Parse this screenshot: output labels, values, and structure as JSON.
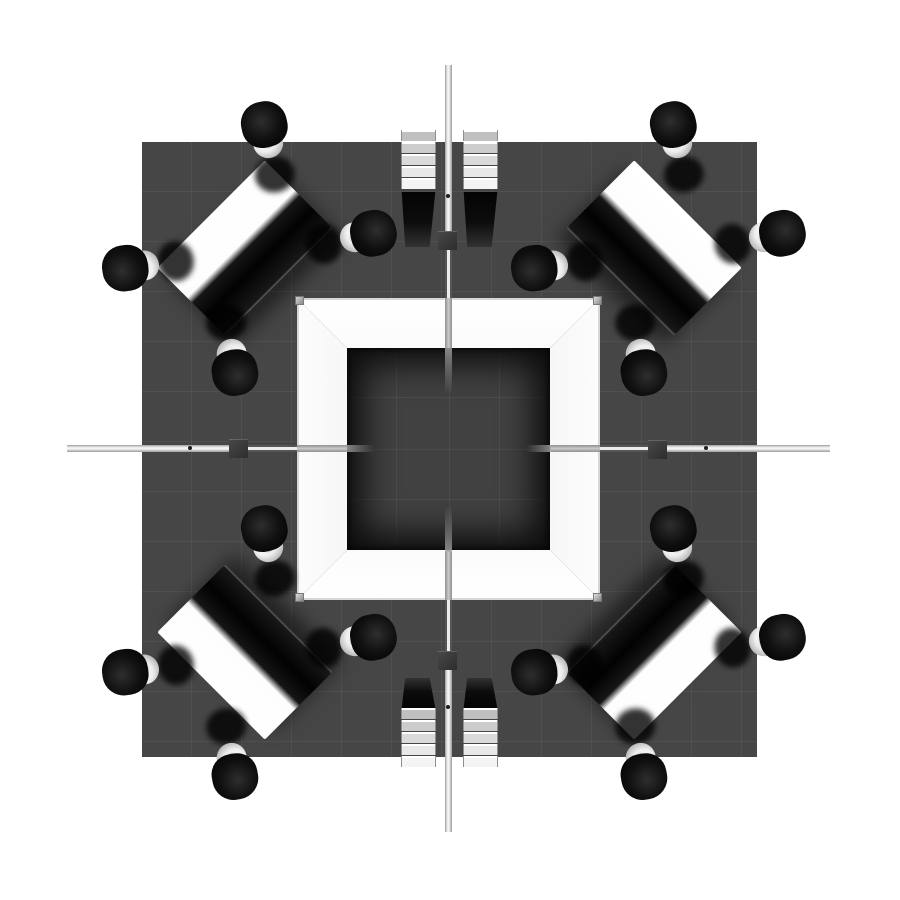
{
  "scene": {
    "title": "Overhead 3D render of a square island trade-show exhibit booth with central tower, four corner meeting tables with chairs, and four ladder display shelves",
    "canvas": {
      "width": 900,
      "height": 900,
      "background": "#ffffff"
    },
    "colors": {
      "floor": "#464646",
      "floor_grid": "rgba(255,255,255,0.055)",
      "court_floor": "#414141",
      "court_grid": "rgba(255,255,255,0.05)",
      "wall_bright": "#ffffff",
      "wall_shade": "#bfbfbf",
      "corner_post": "#b0b0b0",
      "beam_light": "#ededed",
      "beam_edge": "#9a9a9a",
      "connector_block": "#3a3a3a",
      "table_top": "#ffffff",
      "table_dark_half": "#050505",
      "chair_seat": "#0b0b0b",
      "chair_base": "#e8e8e8",
      "shelf_shadow": "#0a0a0a"
    },
    "floor": {
      "x": 142,
      "y": 142,
      "width": 615,
      "height": 615
    },
    "tower": {
      "x": 297,
      "y": 298,
      "width": 303,
      "height": 302,
      "wall_thickness": 50
    },
    "beams": {
      "vertical": {
        "x": 445,
        "width": 7,
        "segments": [
          {
            "kind": "light",
            "from": 65,
            "to": 231
          },
          {
            "kind": "rail",
            "from": 249,
            "to": 298
          },
          {
            "kind": "wall",
            "from": 298,
            "to": 348
          },
          {
            "kind": "stub",
            "from": 348,
            "to": 394,
            "fade": "end"
          },
          {
            "kind": "stub",
            "from": 506,
            "to": 552,
            "fade": "start"
          },
          {
            "kind": "wall",
            "from": 552,
            "to": 600
          },
          {
            "kind": "rail",
            "from": 600,
            "to": 651
          },
          {
            "kind": "light",
            "from": 670,
            "to": 832
          }
        ]
      },
      "horizontal": {
        "y": 445,
        "width": 7,
        "segments": [
          {
            "kind": "light",
            "from": 67,
            "to": 229
          },
          {
            "kind": "rail",
            "from": 248,
            "to": 297
          },
          {
            "kind": "wall",
            "from": 297,
            "to": 347
          },
          {
            "kind": "stub",
            "from": 347,
            "to": 374,
            "fade": "end"
          },
          {
            "kind": "stub",
            "from": 526,
            "to": 551,
            "fade": "start"
          },
          {
            "kind": "wall",
            "from": 551,
            "to": 600
          },
          {
            "kind": "rail",
            "from": 600,
            "to": 648
          },
          {
            "kind": "light",
            "from": 667,
            "to": 830
          }
        ]
      },
      "connector_blocks": [
        {
          "x": 438,
          "y": 231,
          "size": 19
        },
        {
          "x": 438,
          "y": 651,
          "size": 19
        },
        {
          "x": 229,
          "y": 439,
          "size": 19
        },
        {
          "x": 648,
          "y": 440,
          "size": 19
        }
      ],
      "rivets": [
        {
          "x": 190,
          "y": 448
        },
        {
          "x": 706,
          "y": 448
        },
        {
          "x": 448,
          "y": 196
        },
        {
          "x": 448,
          "y": 707
        }
      ]
    },
    "shelf_units": [
      {
        "id": "shelf-top-left",
        "x": 401,
        "y": 130,
        "width": 33,
        "slat_count": 5,
        "slat_region": 62,
        "shadow_region": 55,
        "shadow_side": "bottom"
      },
      {
        "id": "shelf-top-right",
        "x": 463,
        "y": 130,
        "width": 33,
        "slat_count": 5,
        "slat_region": 62,
        "shadow_region": 55,
        "shadow_side": "bottom"
      },
      {
        "id": "shelf-bottom-left",
        "x": 401,
        "y": 678,
        "width": 33,
        "slat_count": 5,
        "slat_region": 60,
        "shadow_region": 30,
        "shadow_side": "top"
      },
      {
        "id": "shelf-bottom-right",
        "x": 463,
        "y": 678,
        "width": 33,
        "slat_count": 5,
        "slat_region": 60,
        "shadow_region": 30,
        "shadow_side": "top"
      }
    ],
    "slat_colors": [
      "#c0c0c0",
      "#cccccc",
      "#dadada",
      "#e8e8e8",
      "#f4f4f4"
    ],
    "table_size": {
      "length": 152,
      "width": 96
    },
    "tables": [
      {
        "id": "table-northwest",
        "cx": 245,
        "cy": 248,
        "rotation": -45,
        "dark_half": "bottom"
      },
      {
        "id": "table-northeast",
        "cx": 654,
        "cy": 248,
        "rotation": 45,
        "dark_half": "bottom"
      },
      {
        "id": "table-southwest",
        "cx": 245,
        "cy": 652,
        "rotation": 45,
        "dark_half": "top"
      },
      {
        "id": "table-southeast",
        "cx": 654,
        "cy": 652,
        "rotation": -45,
        "dark_half": "top"
      }
    ],
    "chairs_per_table": [
      {
        "seat": "north",
        "dx": 24,
        "dy": -101,
        "rotation": -12
      },
      {
        "seat": "east",
        "dx": 106,
        "dy": -10,
        "rotation": 78
      },
      {
        "seat": "south",
        "dx": -14,
        "dy": 102,
        "rotation": 170
      },
      {
        "seat": "west",
        "dx": -97,
        "dy": 17,
        "rotation": 262
      }
    ]
  }
}
